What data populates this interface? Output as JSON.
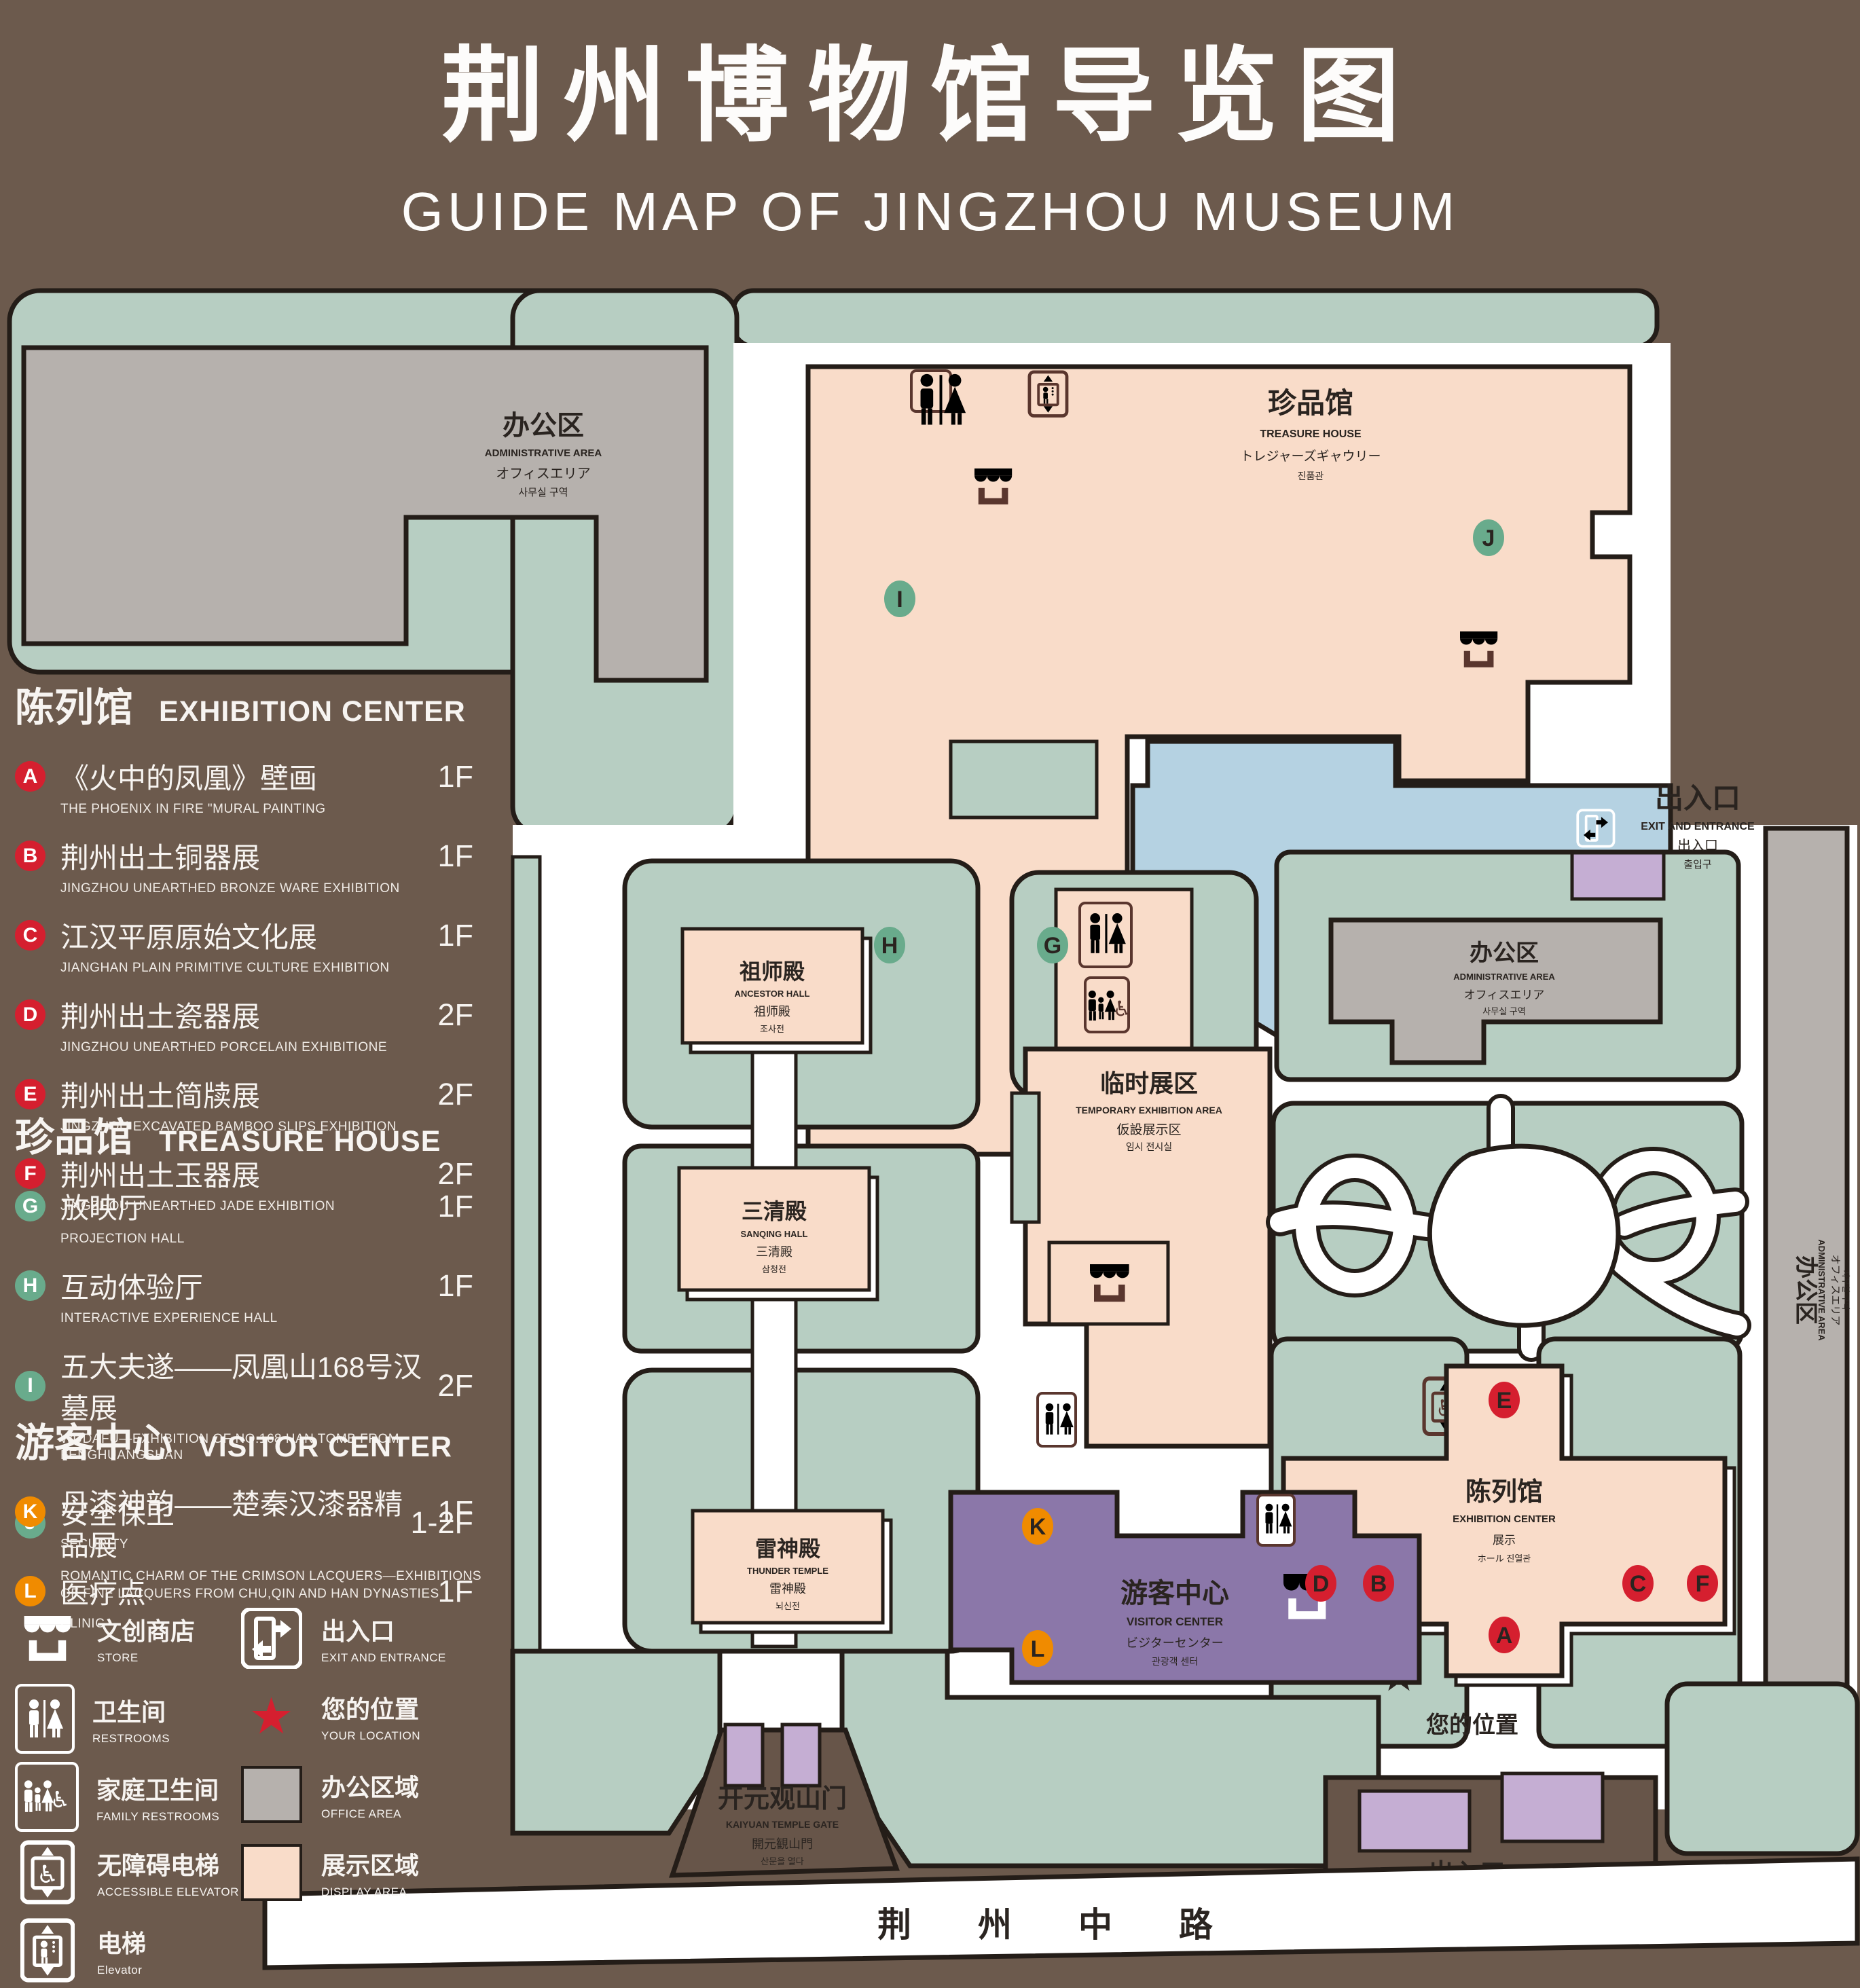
{
  "title": {
    "zh": "荆州博物馆导览图",
    "en": "GUIDE MAP OF JINGZHOU MUSEUM"
  },
  "legend": {
    "sections": [
      {
        "zh": "陈列馆",
        "en": "EXHIBITION CENTER",
        "items": [
          {
            "id": "A",
            "zh": "《火中的凤凰》壁画",
            "en": "THE PHOENIX IN FIRE \"MURAL PAINTING",
            "floor": "1F"
          },
          {
            "id": "B",
            "zh": "荆州出土铜器展",
            "en": "JINGZHOU UNEARTHED BRONZE WARE EXHIBITION",
            "floor": "1F"
          },
          {
            "id": "C",
            "zh": "江汉平原原始文化展",
            "en": "JIANGHAN PLAIN PRIMITIVE CULTURE EXHIBITION",
            "floor": "1F"
          },
          {
            "id": "D",
            "zh": "荆州出土瓷器展",
            "en": "JINGZHOU UNEARTHED PORCELAIN EXHIBITIONE",
            "floor": "2F"
          },
          {
            "id": "E",
            "zh": "荆州出土简牍展",
            "en": "JINGZHOU EXCAVATED BAMBOO SLIPS EXHIBITION",
            "floor": "2F"
          },
          {
            "id": "F",
            "zh": "荆州出土玉器展",
            "en": "JINGZHOU UNEARTHED JADE EXHIBITION",
            "floor": "2F"
          }
        ]
      },
      {
        "zh": "珍品馆",
        "en": "TREASURE HOUSE",
        "items": [
          {
            "id": "G",
            "zh": "放映厅",
            "en": "PROJECTION HALL",
            "floor": "1F"
          },
          {
            "id": "H",
            "zh": "互动体验厅",
            "en": "INTERACTIVE EXPERIENCE HALL",
            "floor": "1F"
          },
          {
            "id": "I",
            "zh": "五大夫遂——凤凰山168号汉墓展",
            "en": "WUDAFU—EXHIBITION OF NO.168 HAN TOMB FROM FENGHUANGSHAN",
            "floor": "2F"
          },
          {
            "id": "J",
            "zh": "丹漆神韵——楚秦汉漆器精品展",
            "en": "ROMANTIC CHARM OF THE CRIMSON LACQUERS—EXHIBITIONS",
            "en2": "OF FINE LACQUERS FROM CHU,QIN AND HAN DYNASTIES",
            "floor": "1-2F"
          }
        ]
      },
      {
        "zh": "游客中心",
        "en": "VISITOR CENTER",
        "items": [
          {
            "id": "K",
            "zh": "安全保卫",
            "en": "SECURITY",
            "floor": "1F"
          },
          {
            "id": "L",
            "zh": "医疗点",
            "en": "CLINIC",
            "floor": "1F"
          }
        ]
      }
    ],
    "icons": {
      "store": {
        "zh": "文创商店",
        "en": "STORE"
      },
      "exit": {
        "zh": "出入口",
        "en": "EXIT AND ENTRANCE"
      },
      "restrooms": {
        "zh": "卫生间",
        "en": "RESTROOMS"
      },
      "your_location": {
        "zh": "您的位置",
        "en": "YOUR LOCATION"
      },
      "family": {
        "zh": "家庭卫生间",
        "en": "FAMILY RESTROOMS"
      },
      "office": {
        "zh": "办公区域",
        "en": "OFFICE AREA"
      },
      "accessible": {
        "zh": "无障碍电梯",
        "en": "ACCESSIBLE ELEVATOR"
      },
      "display": {
        "zh": "展示区域",
        "en": "DISPLAY AREA"
      },
      "elevator": {
        "zh": "电梯",
        "en": "Elevator"
      },
      "star": "★"
    }
  },
  "map": {
    "admin_tl": {
      "zh": "办公区",
      "en": "ADMINISTRATIVE AREA",
      "jp": "オフィスエリア",
      "kr": "사무실 구역"
    },
    "treasure_house": {
      "zh": "珍品馆",
      "en": "TREASURE HOUSE",
      "jp": "トレジャーズギャウリー",
      "kr": "진품관"
    },
    "ancestor_hall": {
      "zh": "祖师殿",
      "en": "ANCESTOR HALL",
      "zh2": "祖师殿",
      "kr": "조사전"
    },
    "sanqing_hall": {
      "zh": "三清殿",
      "en": "SANQING HALL",
      "zh2": "三清殿",
      "kr": "삼청전"
    },
    "thunder_temple": {
      "zh": "雷神殿",
      "en": "THUNDER TEMPLE",
      "zh2": "雷神殿",
      "kr": "뇌신전"
    },
    "temporary_area": {
      "zh": "临时展区",
      "en": "TEMPORARY EXHIBITION AREA",
      "jp": "仮設展示区",
      "kr": "임시 전시실"
    },
    "admin_right": {
      "zh": "办公区",
      "en": "ADMINISTRATIVE AREA",
      "jp": "オフィスエリア",
      "kr": "사무실 구역"
    },
    "admin_strip": {
      "zh": "办公区",
      "en": "ADMINISTRATIVE AREA",
      "jp": "オフィスエリア",
      "kr": "사무실 구역"
    },
    "exhibition_center": {
      "zh": "陈列馆",
      "en": "EXHIBITION CENTER",
      "zh2": "展示",
      "l4": "ホール 진열관"
    },
    "visitor_center": {
      "zh": "游客中心",
      "en": "VISITOR CENTER",
      "jp": "ビジターセンター",
      "kr": "관광객 센터"
    },
    "gate": {
      "zh": "开元观山门",
      "en": "KAIYUAN TEMPLE GATE",
      "jp": "開元観山門",
      "kr": "산문을 열다"
    },
    "exit_tr": {
      "zh": "出入口",
      "en": "EXIT AND ENTRANCE",
      "zh2": "出入口",
      "kr": "출입구"
    },
    "exit_bottom": {
      "zh": "出入口",
      "en": "EXIT AND ENTRANCE",
      "zh2": "出入口",
      "kr": "출입구"
    },
    "road": {
      "zh": "荆 州 中 路"
    },
    "your_location": "您的位置",
    "markers": {
      "A": "A",
      "B": "B",
      "C": "C",
      "D": "D",
      "E": "E",
      "F": "F",
      "G": "G",
      "H": "H",
      "I": "I",
      "J": "J",
      "K": "K",
      "L": "L"
    }
  },
  "colors": {
    "background": "#6c5a4d",
    "map_green": "#b7cec2",
    "building_pink": "#f9dcc9",
    "office_gray": "#b6b1ad",
    "pond_blue": "#b5d2e2",
    "gate_purple": "#c5aed3",
    "badge_red": "#d51f2f",
    "badge_green": "#69ab8c",
    "badge_orange": "#f08b00",
    "icon_brown": "#5a362e",
    "outline": "#241d18",
    "location_red": "#d51f2f"
  }
}
